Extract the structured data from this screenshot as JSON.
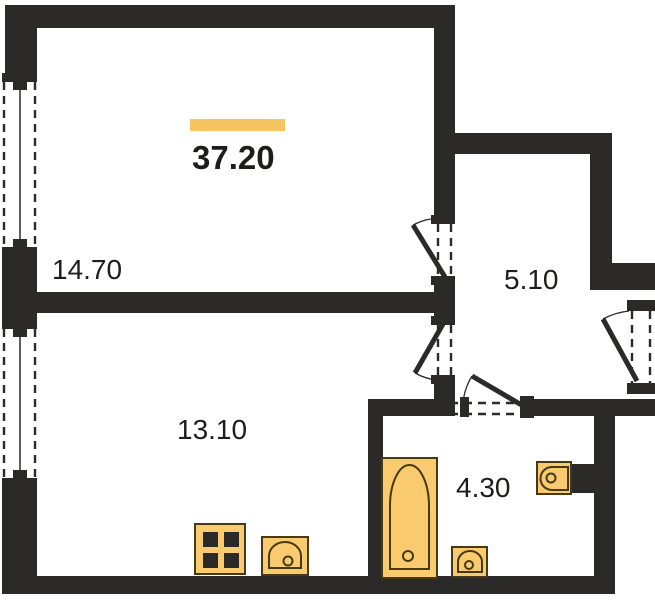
{
  "plan": {
    "total": {
      "area": "37.20"
    },
    "rooms": [
      {
        "name": "room-top-left",
        "area": "14.70"
      },
      {
        "name": "hallway",
        "area": "5.10"
      },
      {
        "name": "room-bottom-left",
        "area": "13.10"
      },
      {
        "name": "bathroom",
        "area": "4.30"
      }
    ],
    "fixtures": [
      "bathtub",
      "bathroom-sink",
      "toilet",
      "stove",
      "kitchen-sink"
    ],
    "openings": [
      "window-top-left",
      "window-bottom-left",
      "door-room-top",
      "door-room-bottom",
      "door-bathroom",
      "door-entrance"
    ],
    "colors": {
      "wall": "#2b2a28",
      "accent": "#f6c562",
      "fixture_fill": "#f9ca6e",
      "fixture_stroke": "#453a14",
      "fixture_dark": "#2b2a28",
      "text": "#1d1d1b"
    }
  }
}
